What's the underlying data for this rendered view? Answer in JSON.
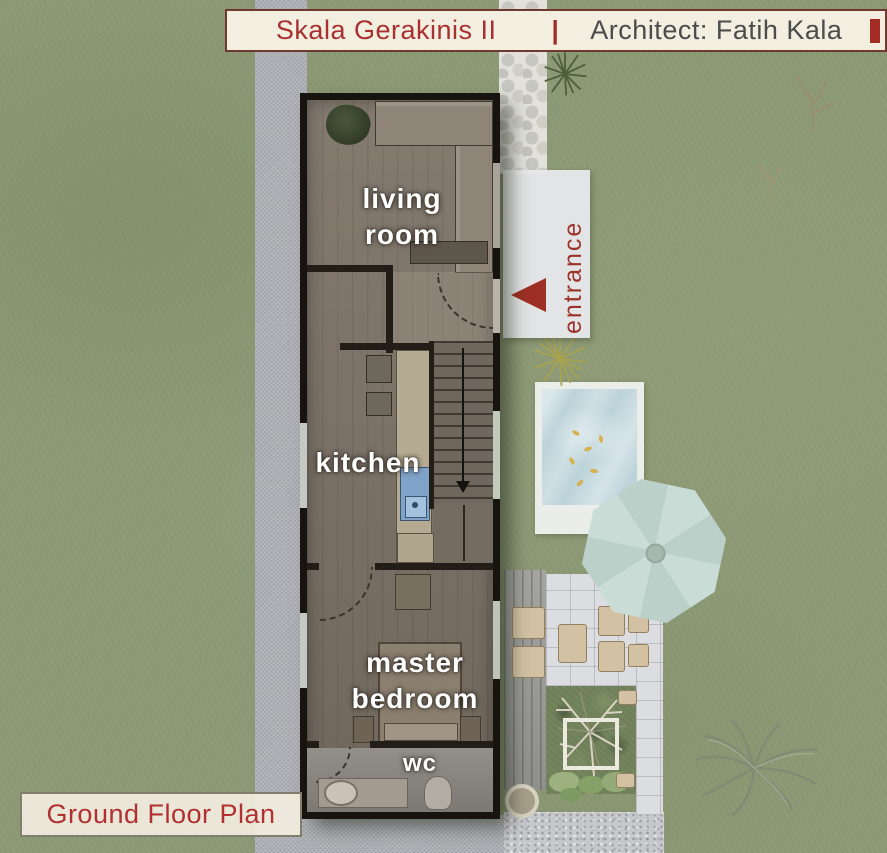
{
  "header": {
    "project": "Skala Gerakinis II",
    "divider": "|",
    "architect": "Architect: Fatih Kala"
  },
  "footer": {
    "plan_label": "Ground Floor Plan"
  },
  "rooms": {
    "living_room": "living room",
    "kitchen": "kitchen",
    "master_bedroom": "master bedroom",
    "wc": "wc"
  },
  "site": {
    "entrance_label": "entrance",
    "entrance_arrow_icon": "triangle-pointing-left",
    "stairs_arrow_icon": "arrow-down"
  },
  "colors": {
    "accent_red": "#a32c24",
    "header_bg": "#f2eee0",
    "header_title_red": "#a93030",
    "architect_text": "#4c4c4c",
    "plan_label_red": "#b23030",
    "grass": "#8d9a76",
    "road": "#b1b3b8",
    "wall": "#17130e",
    "wood_floor": "#7d7367",
    "pool_water": "#bcd3da",
    "umbrella": "#c4d7d0",
    "patio_tile": "#dbdde1",
    "deck": "#9c9c98",
    "lounge_beige": "#d2c2a3"
  }
}
